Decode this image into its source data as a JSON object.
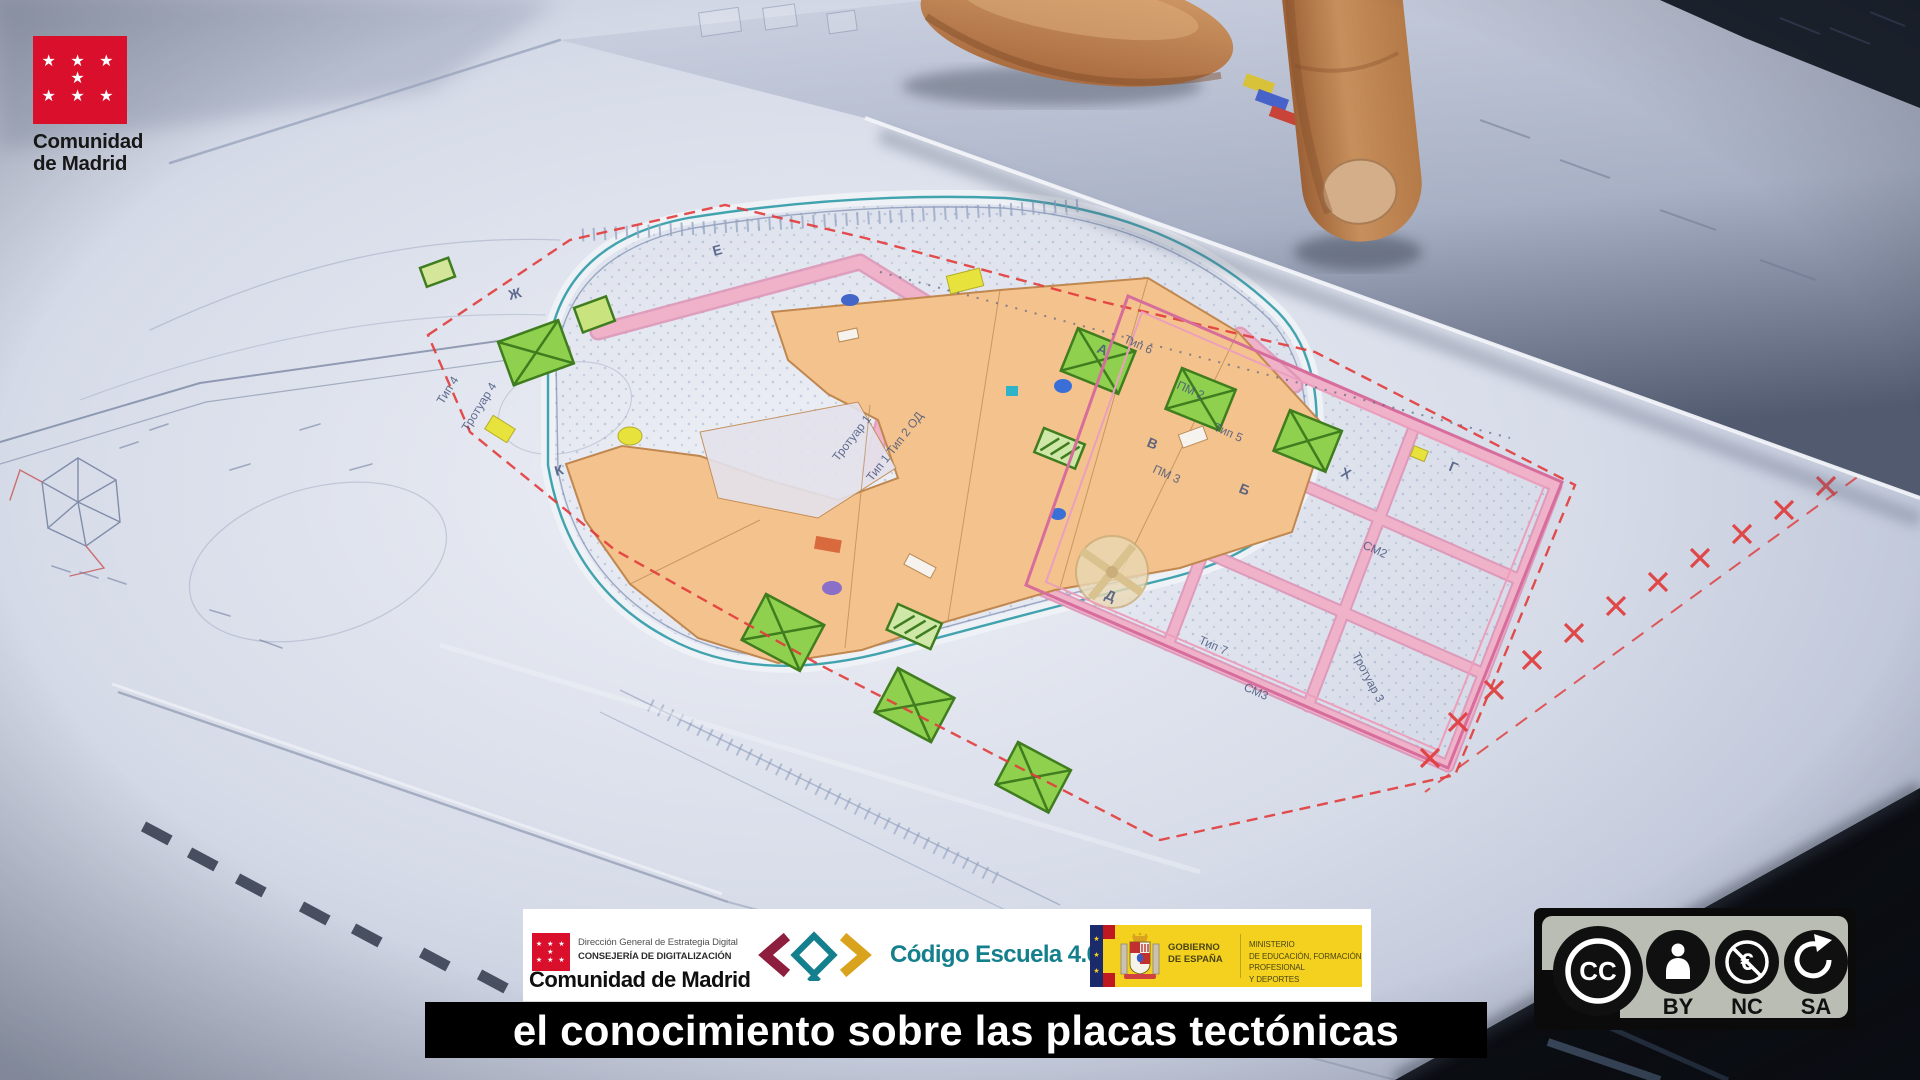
{
  "overlay": {
    "watermark": {
      "stars_row1": "★ ★ ★ ★",
      "stars_row2": "★ ★ ★",
      "name_line1": "Comunidad",
      "name_line2": "de Madrid"
    },
    "subtitle": "el conocimiento sobre las placas tectónicas"
  },
  "banner": {
    "madrid": {
      "stars_row1": "★ ★ ★ ★",
      "stars_row2": "★ ★ ★",
      "dept_line1": "Dirección General de Estrategia Digital",
      "dept_line2": "CONSEJERÍA DE DIGITALIZACIÓN",
      "org": "Comunidad de Madrid"
    },
    "codigo": {
      "name": "Código Escuela 4.0"
    },
    "spain": {
      "eu_stars": "★ ★ ★",
      "gov_line1": "GOBIERNO",
      "gov_line2": "DE ESPAÑA",
      "ministry_line1": "MINISTERIO",
      "ministry_line2": "DE EDUCACIÓN, FORMACIÓN PROFESIONAL",
      "ministry_line3": "Y DEPORTES"
    }
  },
  "license": {
    "cc": "CC",
    "nc_symbol": "€",
    "labels": [
      "BY",
      "NC",
      "SA"
    ]
  },
  "colors": {
    "madrid_red": "#da0f2c",
    "codigo_teal": "#15808d",
    "codigo_maroon": "#8e1e3e",
    "codigo_gold": "#d9a31e",
    "spain_yellow": "#f3d11e",
    "cc_panel_gray": "#b9bdb3",
    "subtitle_bg": "#000000",
    "subtitle_fg": "#ffffff",
    "plan_orange": "#f4c28c",
    "plan_pink": "#f0b4ca",
    "plan_green": "#8fd14f",
    "plan_red_boundary": "#e23b3b",
    "plan_teal_road": "#2e9aa6"
  },
  "plan_labels": [
    {
      "text": "Тротуар 1"
    },
    {
      "text": "Тип 1 Тип 2 ОД"
    },
    {
      "text": "Тип 4"
    },
    {
      "text": "Тротуар 4"
    },
    {
      "text": "Тип 5"
    },
    {
      "text": "Тип 6"
    },
    {
      "text": "ПМ 2"
    },
    {
      "text": "ПМ 3"
    },
    {
      "text": "СМ2"
    },
    {
      "text": "СМ3"
    },
    {
      "text": "Тип 7"
    },
    {
      "text": "Тротуар 3"
    },
    {
      "text": "А"
    },
    {
      "text": "Б"
    },
    {
      "text": "В"
    },
    {
      "text": "Г"
    },
    {
      "text": "Д"
    },
    {
      "text": "Е"
    },
    {
      "text": "Ж"
    },
    {
      "text": "К"
    },
    {
      "text": "Х"
    }
  ]
}
